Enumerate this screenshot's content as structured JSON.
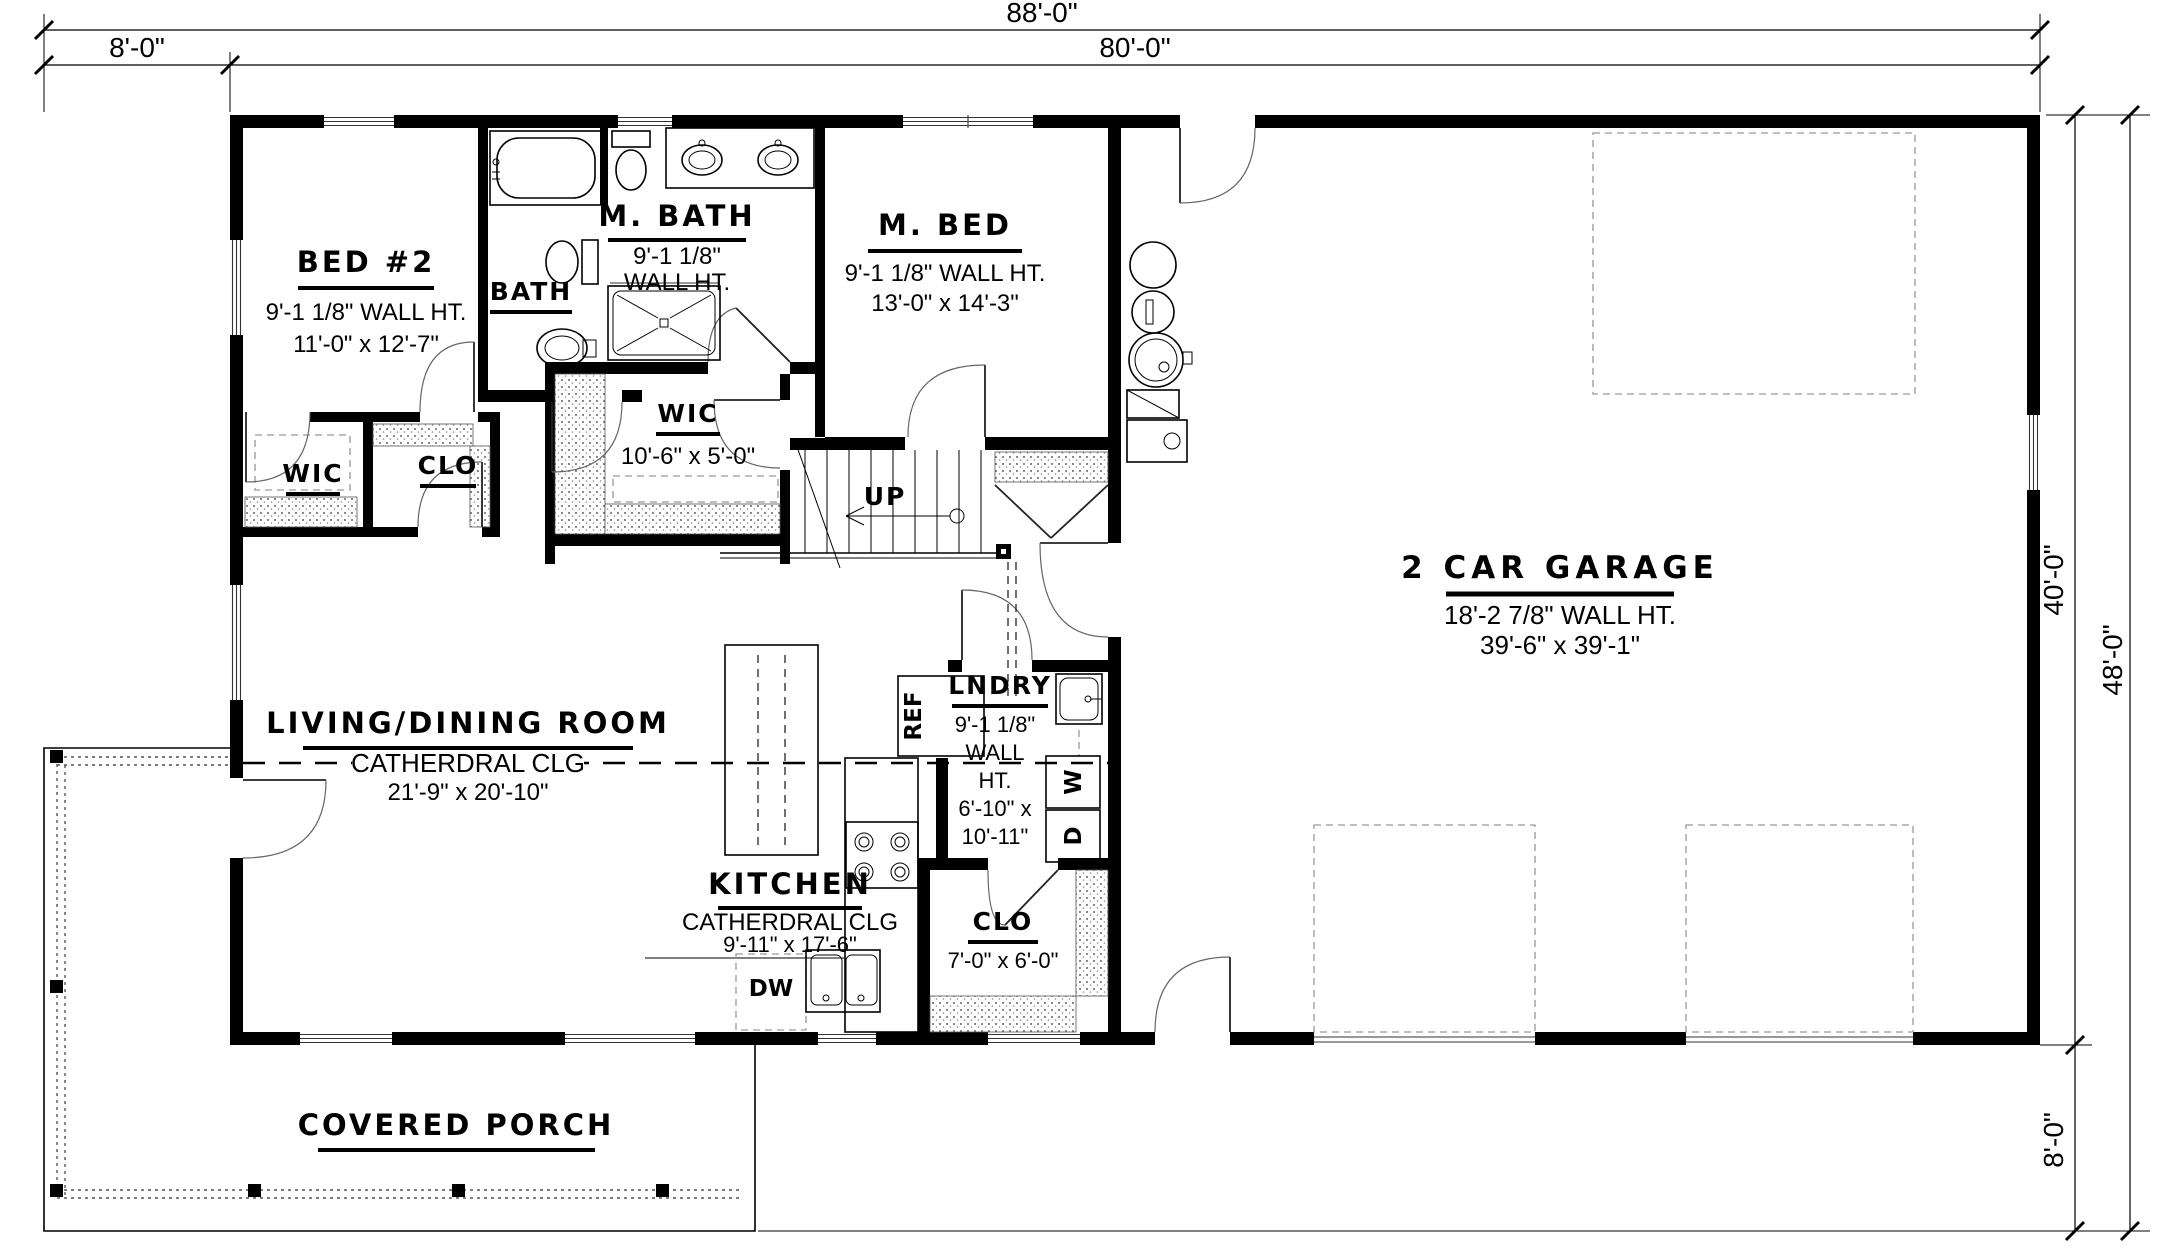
{
  "dims": {
    "overall_width": "88'-0\"",
    "porch_offset": "8'-0\"",
    "main_width": "80'-0\"",
    "main_depth": "40'-0\"",
    "overall_depth": "48'-0\"",
    "porch_depth": "8'-0\""
  },
  "rooms": {
    "bed2": {
      "name": "BED #2",
      "wall_ht": "9'-1 1/8\" WALL HT.",
      "size": "11'-0\" x 12'-7\""
    },
    "bath": {
      "name": "BATH"
    },
    "mbath": {
      "name": "M. BATH",
      "wall_ht1": "9'-1 1/8\"",
      "wall_ht2": "WALL HT."
    },
    "mbed": {
      "name": "M. BED",
      "wall_ht": "9'-1 1/8\" WALL HT.",
      "size": "13'-0\" x 14'-3\""
    },
    "wic_left": {
      "name": "WIC"
    },
    "clo_left": {
      "name": "CLO"
    },
    "wic": {
      "name": "WIC",
      "size": "10'-6\" x 5'-0\""
    },
    "garage": {
      "name": "2 CAR GARAGE",
      "wall_ht": "18'-2 7/8\" WALL HT.",
      "size": "39'-6\" x 39'-1\""
    },
    "living": {
      "name": "LIVING/DINING ROOM",
      "ceiling": "CATHERDRAL CLG",
      "size": "21'-9\" x 20'-10\""
    },
    "kitchen": {
      "name": "KITCHEN",
      "ceiling": "CATHERDRAL CLG",
      "size": "9'-11\" x 17'-6\""
    },
    "laundry": {
      "name": "LNDRY",
      "l1": "9'-1 1/8\"",
      "l2": "WALL",
      "l3": "HT.",
      "l4": "6'-10\" x",
      "l5": "10'-11\""
    },
    "clo_kitchen": {
      "name": "CLO",
      "size": "7'-0\" x 6'-0\""
    },
    "porch": {
      "name": "COVERED PORCH"
    }
  },
  "annotations": {
    "up": "UP",
    "ref": "REF",
    "dw": "DW",
    "washer": "W",
    "dryer": "D"
  }
}
